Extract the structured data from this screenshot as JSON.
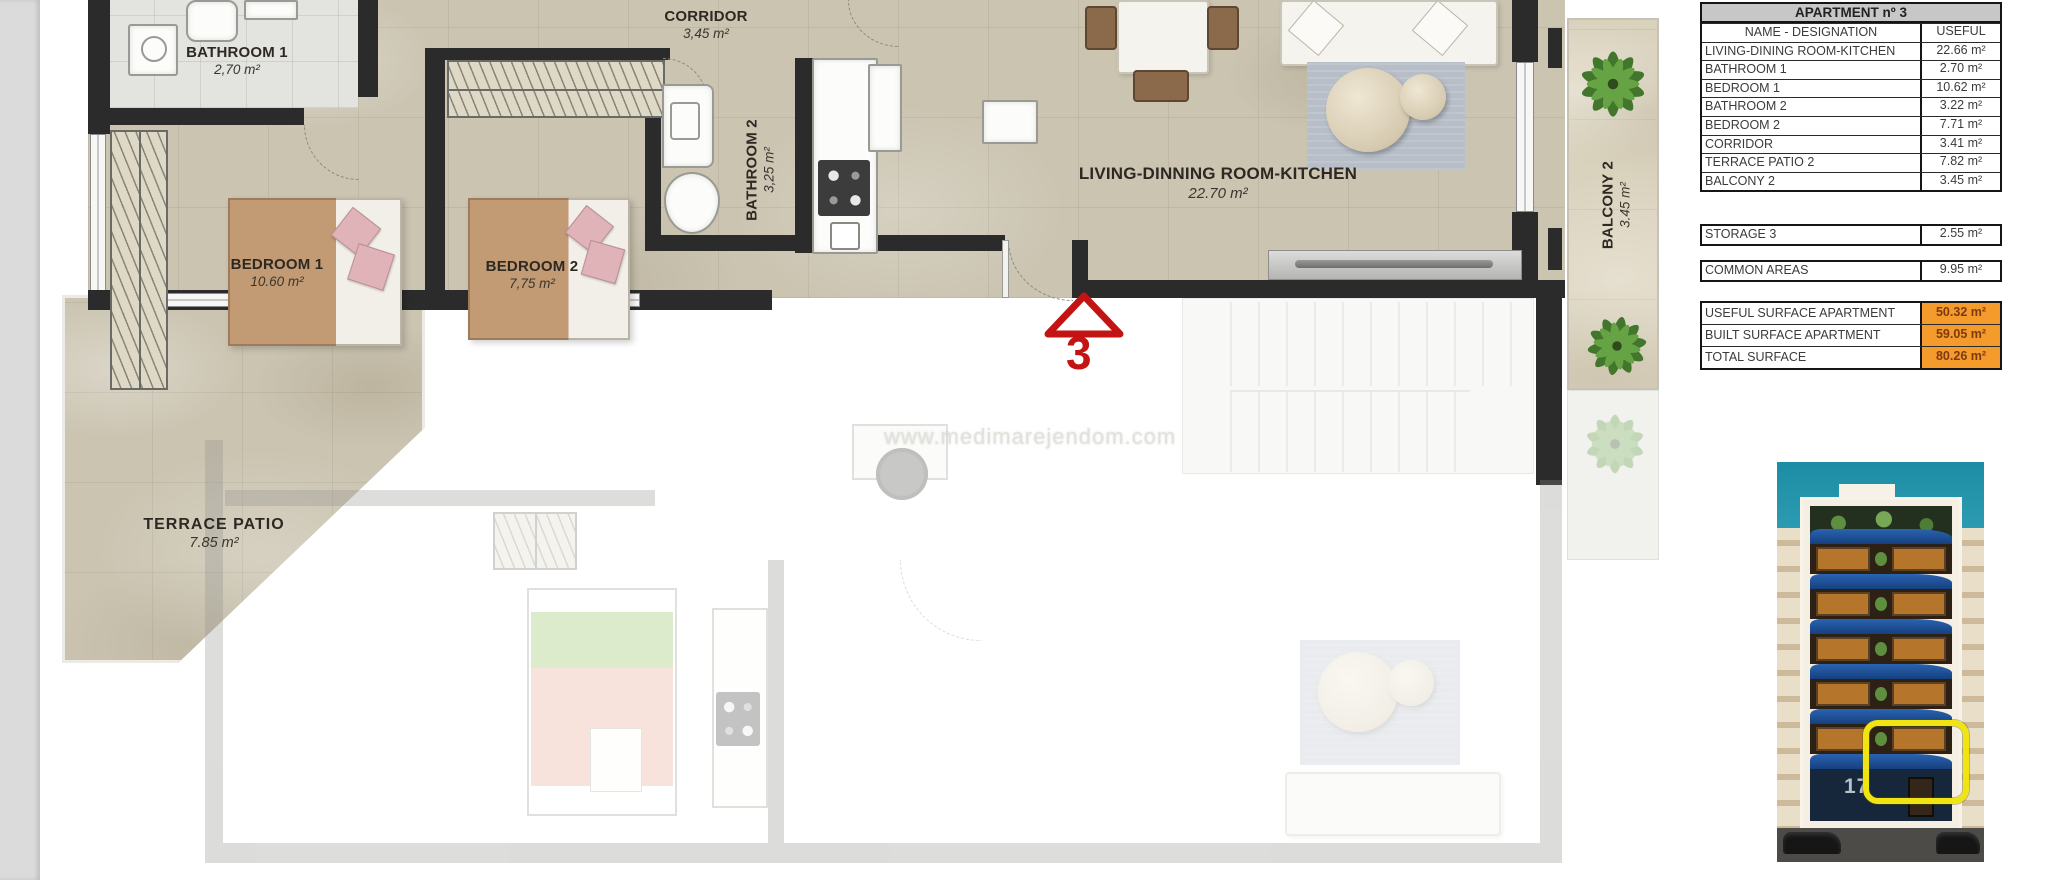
{
  "plan": {
    "watermark": "www.medimarejendom.com",
    "unit_marker": "3",
    "rooms": {
      "bathroom1": {
        "name": "BATHROOM 1",
        "area": "2,70 m²"
      },
      "corridor": {
        "name": "CORRIDOR",
        "area": "3,45 m²"
      },
      "bathroom2": {
        "name": "BATHROOM 2",
        "area": "3,25 m²"
      },
      "bedroom1": {
        "name": "BEDROOM 1",
        "area": "10.60 m²"
      },
      "bedroom2": {
        "name": "BEDROOM 2",
        "area": "7,75 m²"
      },
      "living": {
        "name": "LIVING-DINNING ROOM-KITCHEN",
        "area": "22.70 m²"
      },
      "terrace": {
        "name": "TERRACE  PATIO",
        "area": "7.85 m²"
      },
      "balcony2": {
        "name": "BALCONY 2",
        "area": "3.45 m²"
      }
    }
  },
  "table": {
    "title": "APARTMENT nº 3",
    "col_name": "NAME - DESIGNATION",
    "col_useful": "USEFUL",
    "rows": [
      {
        "name": "LIVING-DINING ROOM-KITCHEN",
        "value": "22.66 m²"
      },
      {
        "name": "BATHROOM 1",
        "value": "2.70 m²"
      },
      {
        "name": "BEDROOM 1",
        "value": "10.62 m²"
      },
      {
        "name": "BATHROOM 2",
        "value": "3.22 m²"
      },
      {
        "name": "BEDROOM 2",
        "value": "7.71 m²"
      },
      {
        "name": "CORRIDOR",
        "value": "3.41 m²"
      },
      {
        "name": "TERRACE PATIO 2",
        "value": "7.82 m²"
      },
      {
        "name": "BALCONY 2",
        "value": "3.45 m²"
      }
    ],
    "storage": {
      "name": "STORAGE 3",
      "value": "2.55 m²"
    },
    "common": {
      "name": "COMMON AREAS",
      "value": "9.95 m²"
    },
    "totals": [
      {
        "name": "USEFUL SURFACE APARTMENT",
        "value": "50.32 m²"
      },
      {
        "name": "BUILT SURFACE APARTMENT",
        "value": "59.05 m²"
      },
      {
        "name": "TOTAL SURFACE",
        "value": "80.26 m²"
      }
    ]
  },
  "building": {
    "street_number": "17"
  },
  "colors": {
    "highlight_orange": "#F49B2B",
    "marker_red": "#C31313",
    "highlight_yellow": "#F0E512",
    "sky_teal": "#2E9CB0",
    "balcony_blue": "#1D4F9E",
    "wall_dark": "#2B2B2B",
    "floor_beige": "#CBC4B1"
  }
}
